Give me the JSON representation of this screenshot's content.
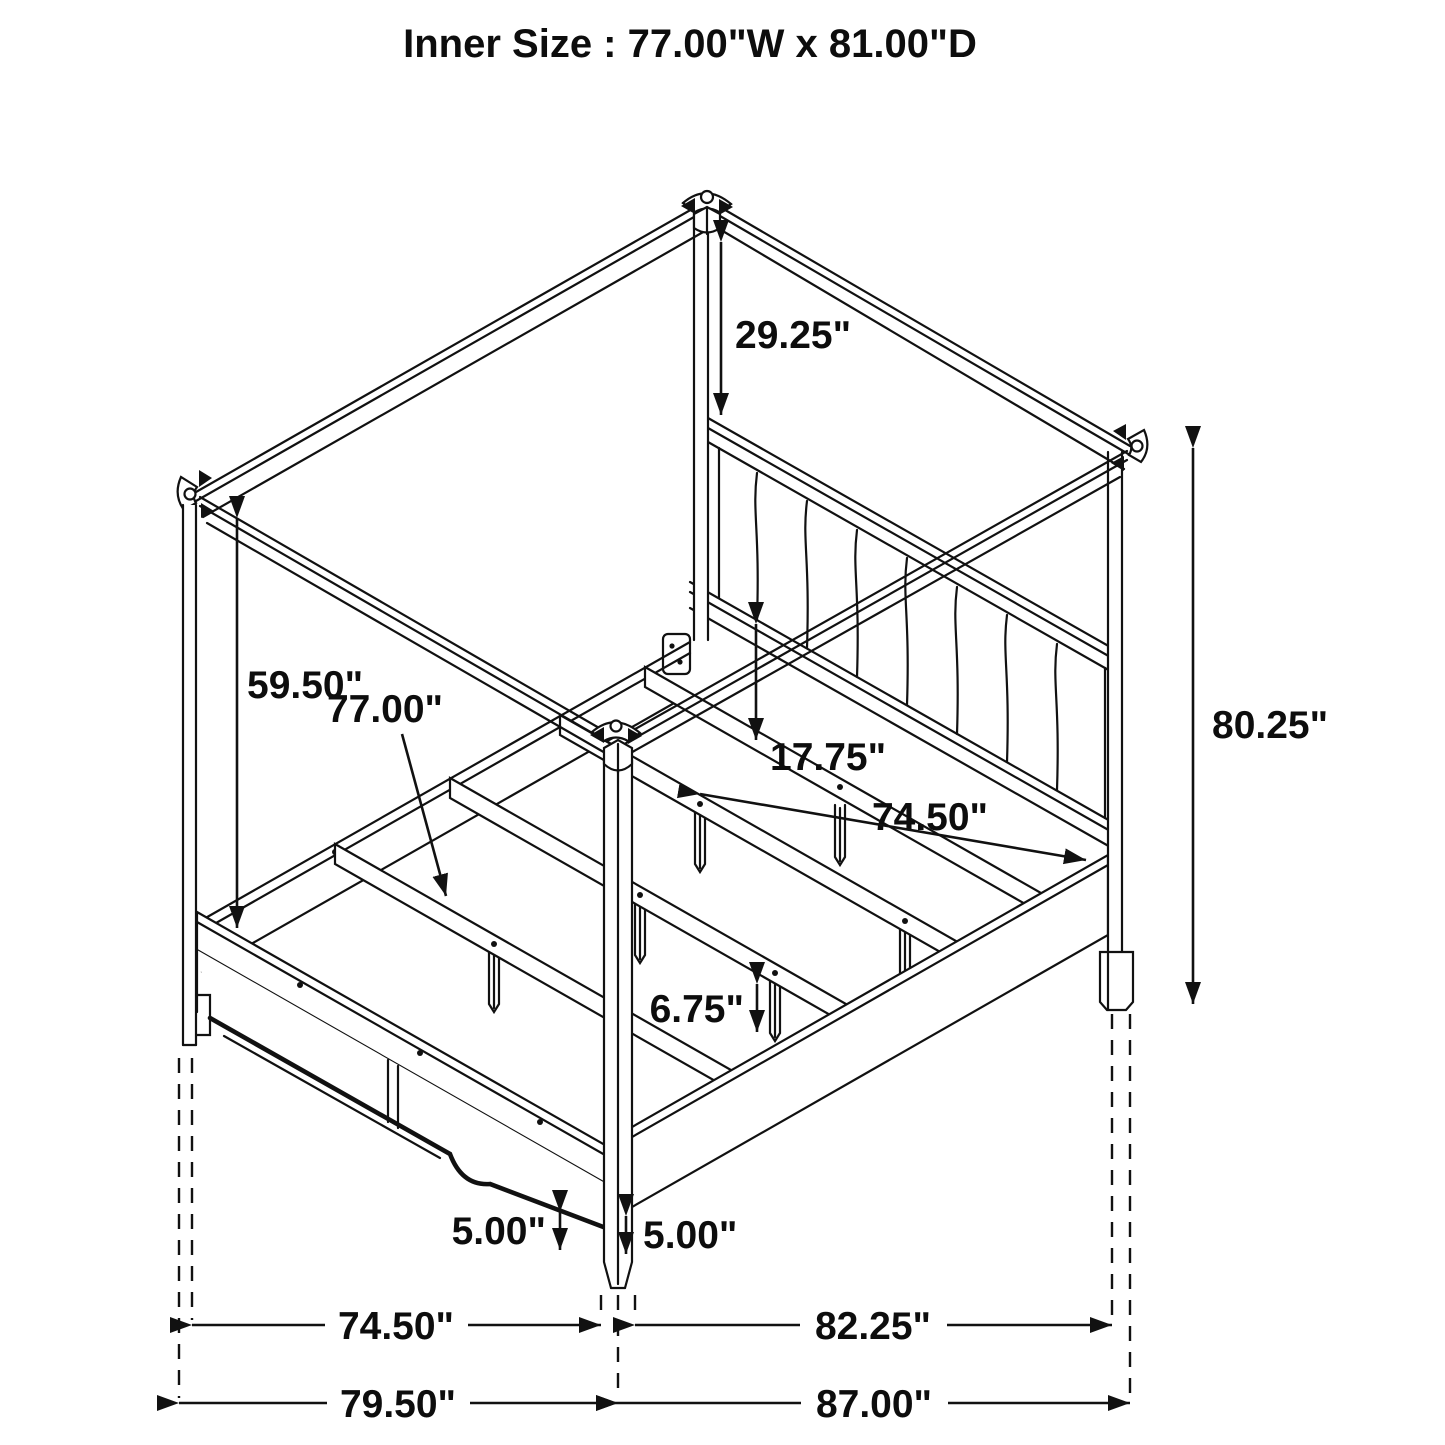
{
  "title": "Inner Size : 77.00\"W x 81.00\"D",
  "drawing": {
    "type": "furniture-assembly-dimension-diagram",
    "subject": "four-poster canopy bed with upholstered channel-tufted headboard, slat system and footboard",
    "line_color": "#111111",
    "background_color": "#ffffff"
  },
  "dimensions": {
    "headboard_post_top_gap": "29.25\"",
    "canopy_to_rail_drop": "59.50\"",
    "slat_length": "77.00\"",
    "rail_to_slat_height": "17.75\"",
    "side_rail_length": "74.50\"",
    "post_height": "80.25\"",
    "support_leg_height": "6.75\"",
    "floor_clearance_left": "5.00\"",
    "floor_clearance_right": "5.00\"",
    "bottom_width_inner": "74.50\"",
    "bottom_width_outer": "79.50\"",
    "bottom_depth_inner": "82.25\"",
    "bottom_depth_outer": "87.00\""
  }
}
